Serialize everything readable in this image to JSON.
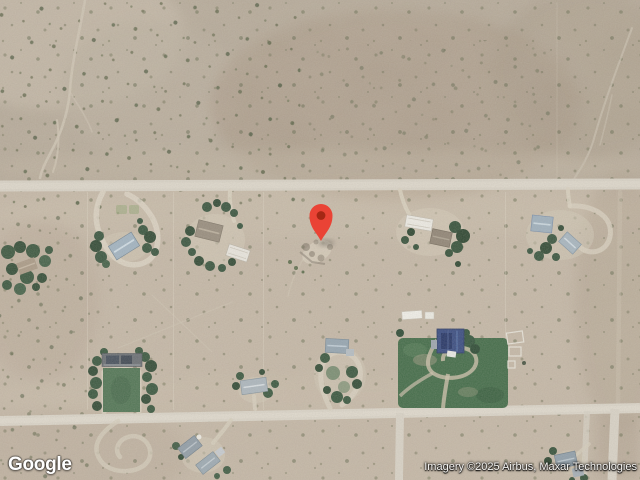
{
  "map": {
    "marker": {
      "color": "#EA4335",
      "dot_color": "#A52714"
    }
  },
  "branding": {
    "logo_text": "Google"
  },
  "attribution": {
    "text": "Imagery ©2025 Airbus, Maxar Technologies"
  }
}
